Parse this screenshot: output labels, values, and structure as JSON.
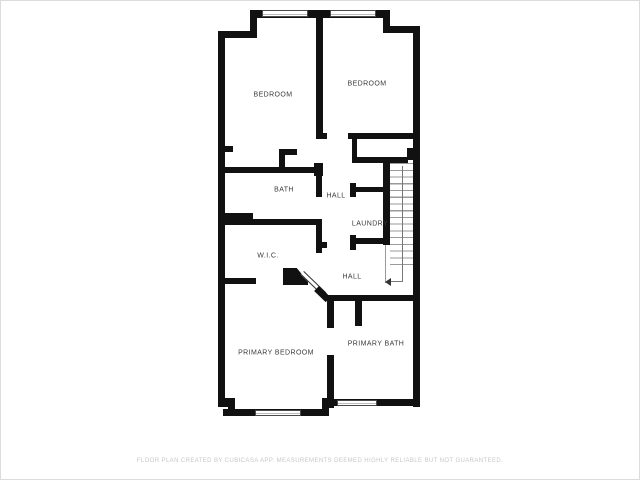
{
  "floor_plan": {
    "rooms": [
      {
        "id": "bedroom-left",
        "label": "BEDROOM"
      },
      {
        "id": "bedroom-right",
        "label": "BEDROOM"
      },
      {
        "id": "bath",
        "label": "BATH"
      },
      {
        "id": "hall-upper",
        "label": "HALL"
      },
      {
        "id": "laundry",
        "label": "LAUNDRY"
      },
      {
        "id": "wic",
        "label": "W.I.C."
      },
      {
        "id": "hall-lower",
        "label": "HALL"
      },
      {
        "id": "primary-bedroom",
        "label": "PRIMARY BEDROOM"
      },
      {
        "id": "primary-bath",
        "label": "PRIMARY BATH"
      }
    ],
    "features": {
      "windows_count": 4,
      "stairs": "staircase with down direction arrow at lower right"
    },
    "colors": {
      "wall": "#111111",
      "label": "#3a3a3a",
      "window_line": "#4a4a4a",
      "stair_line": "#9a9a9a",
      "footer_text": "#c7c7c7"
    }
  },
  "footer": {
    "disclaimer": "FLOOR PLAN CREATED BY CUBICASA APP. MEASUREMENTS DEEMED HIGHLY RELIABLE BUT NOT GUARANTEED."
  }
}
